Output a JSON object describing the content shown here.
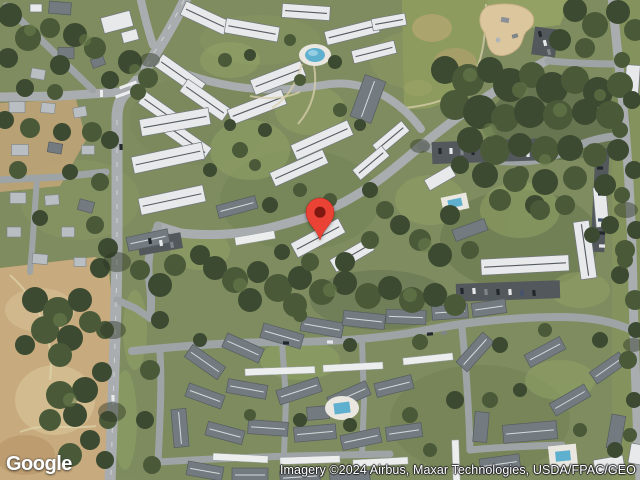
{
  "map": {
    "view": "satellite",
    "marker": {
      "icon": "location-pin-icon",
      "color": "#EA4335",
      "core_color": "#801812"
    },
    "logo": {
      "text": "Google"
    },
    "attribution": {
      "text": "Imagery ©2024 Airbus, Maxar Technologies, USDA/FPAC/GEO"
    },
    "palette": {
      "pin": "#EA4335",
      "pin-core": "#801812",
      "pool": "#5FB0CF",
      "road": "#A9ADB0",
      "field-tan": "#C7AA7E",
      "tree-dark": "#3C4A31",
      "grass": "#7F8C5F",
      "roof-light": "#E7E9EA",
      "roof-dark": "#747B80"
    }
  }
}
